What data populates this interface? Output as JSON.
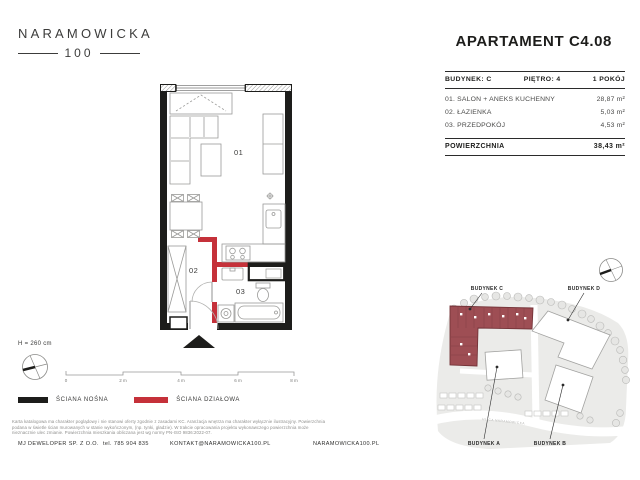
{
  "brand": {
    "name": "NARAMOWICKA",
    "number": "100"
  },
  "title": "APARTAMENT C4.08",
  "info": {
    "building": "BUDYNEK: C",
    "floor": "PIĘTRO: 4",
    "rooms": "1 POKÓJ",
    "items": [
      {
        "name": "01. SALON + ANEKS KUCHENNY",
        "area": "28,87 m²"
      },
      {
        "name": "02. ŁAZIENKA",
        "area": "5,03 m²"
      },
      {
        "name": "03. PRZEDPOKÓJ",
        "area": "4,53 m²"
      }
    ],
    "total_label": "POWIERZCHNIA",
    "total_area": "38,43 m²"
  },
  "plan": {
    "room_labels": {
      "room1": "01",
      "room2": "02",
      "room3": "03"
    },
    "height_note": "H = 260 cm",
    "scale_ticks": [
      "0",
      "2 m",
      "4 m",
      "6 m",
      "8 m"
    ]
  },
  "legend": {
    "load_bearing_label": "ŚCIANA NOŚNA",
    "partition_label": "ŚCIANA DZIAŁOWA",
    "load_bearing_color": "#1d1d1b",
    "partition_color": "#c5313a"
  },
  "site_map": {
    "building_c": "BUDYNEK C",
    "building_d": "BUDYNEK D",
    "building_a": "BUDYNEK A",
    "building_b": "BUDYNEK B",
    "road": "ULICA NARAMOWICKA",
    "highlight_color": "#9e4e54"
  },
  "disclaimer": {
    "line1": "Karta katalogowa ma charakter poglądowy i nie stanowi oferty zgodnie z zasadami KC. Aranżacja wnętrza ma charakter wyłącznie ilustracyjny. Powierzchnia",
    "line2": "podana w świetle ścian murowanych w stanie wykończonym, (np. tynki, gładzie). W trakcie opracowania projektu wykonawczego powierzchnia może",
    "line3": "nieznacznie ulec zmianie. Powierzchnia mieszkania obliczana jest wg normy PN-ISO 9836:2022-07."
  },
  "footer": {
    "company": "MJ DEWELOPER SP. Z O.O.",
    "phone": "tel. 785 904 835",
    "email": "KONTAKT@NARAMOWICKA100.PL",
    "website": "NARAMOWICKA100.PL"
  }
}
